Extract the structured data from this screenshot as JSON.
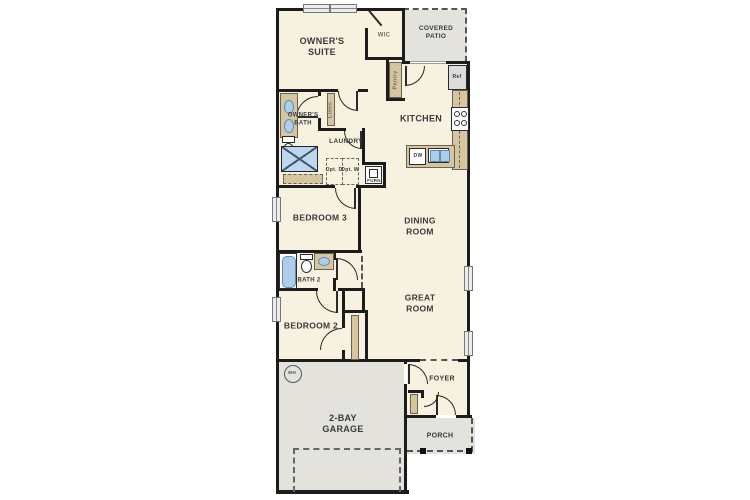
{
  "plan_title": "single-story-floor-plan",
  "labels": {
    "owners_suite": "OWNER'S SUITE",
    "wic": "WIC",
    "covered_patio": "COVERED PATIO",
    "owners_bath": "OWNER'S BATH",
    "linen": "Linen",
    "pantry": "Pantry",
    "kitchen": "KITCHEN",
    "laundry": "LAUNDRY",
    "bedroom3": "BEDROOM 3",
    "dining_room": "DINING ROOM",
    "bath2": "BATH 2",
    "bedroom2": "BEDROOM 2",
    "great_room": "GREAT ROOM",
    "garage": "2-BAY GARAGE",
    "foyer": "FOYER",
    "porch": "PORCH"
  },
  "fixtures": {
    "refrigerator": "Ref",
    "dishwasher": "DW",
    "water_heater": "WH",
    "furnace": "FURN",
    "opt_dryer": "Opt. D",
    "opt_washer": "Opt. W"
  },
  "colors": {
    "wall": "#1c1c1c",
    "interior_fill": "#f7f1df",
    "outdoor_fill": "#e3e2dd",
    "counter_tan": "#d6c69f",
    "fixture_blue": "#aecdea",
    "dashed_line": "#555555"
  }
}
